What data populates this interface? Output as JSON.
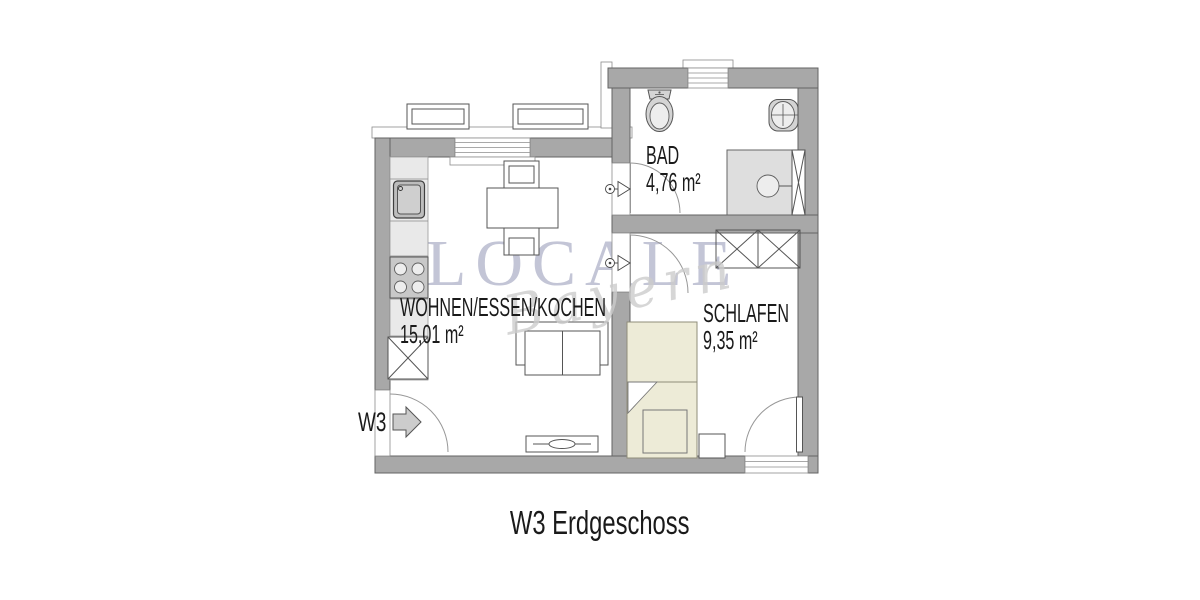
{
  "title": "W3 Erdgeschoss",
  "watermark": {
    "brand": "LOCALE",
    "script": "Bayern"
  },
  "entrance": {
    "label": "W3"
  },
  "rooms": {
    "living": {
      "name": "WOHNEN/ESSEN/KOCHEN",
      "area": "15,01 m²"
    },
    "bath": {
      "name": "BAD",
      "area": "4,76 m²"
    },
    "bedroom": {
      "name": "SCHLAFEN",
      "area": "9,35 m²"
    }
  },
  "colors": {
    "wall": "#a8a8a8",
    "wallline": "#636363",
    "counter": "#e9e9e9",
    "fixture": "#d4d4d4",
    "shower": "#dedede",
    "bed": "#edebd7",
    "arrow": "#cccccc",
    "wm": "#c3c5d6",
    "script": "#cccccc",
    "ink": "#1a1a1a"
  }
}
